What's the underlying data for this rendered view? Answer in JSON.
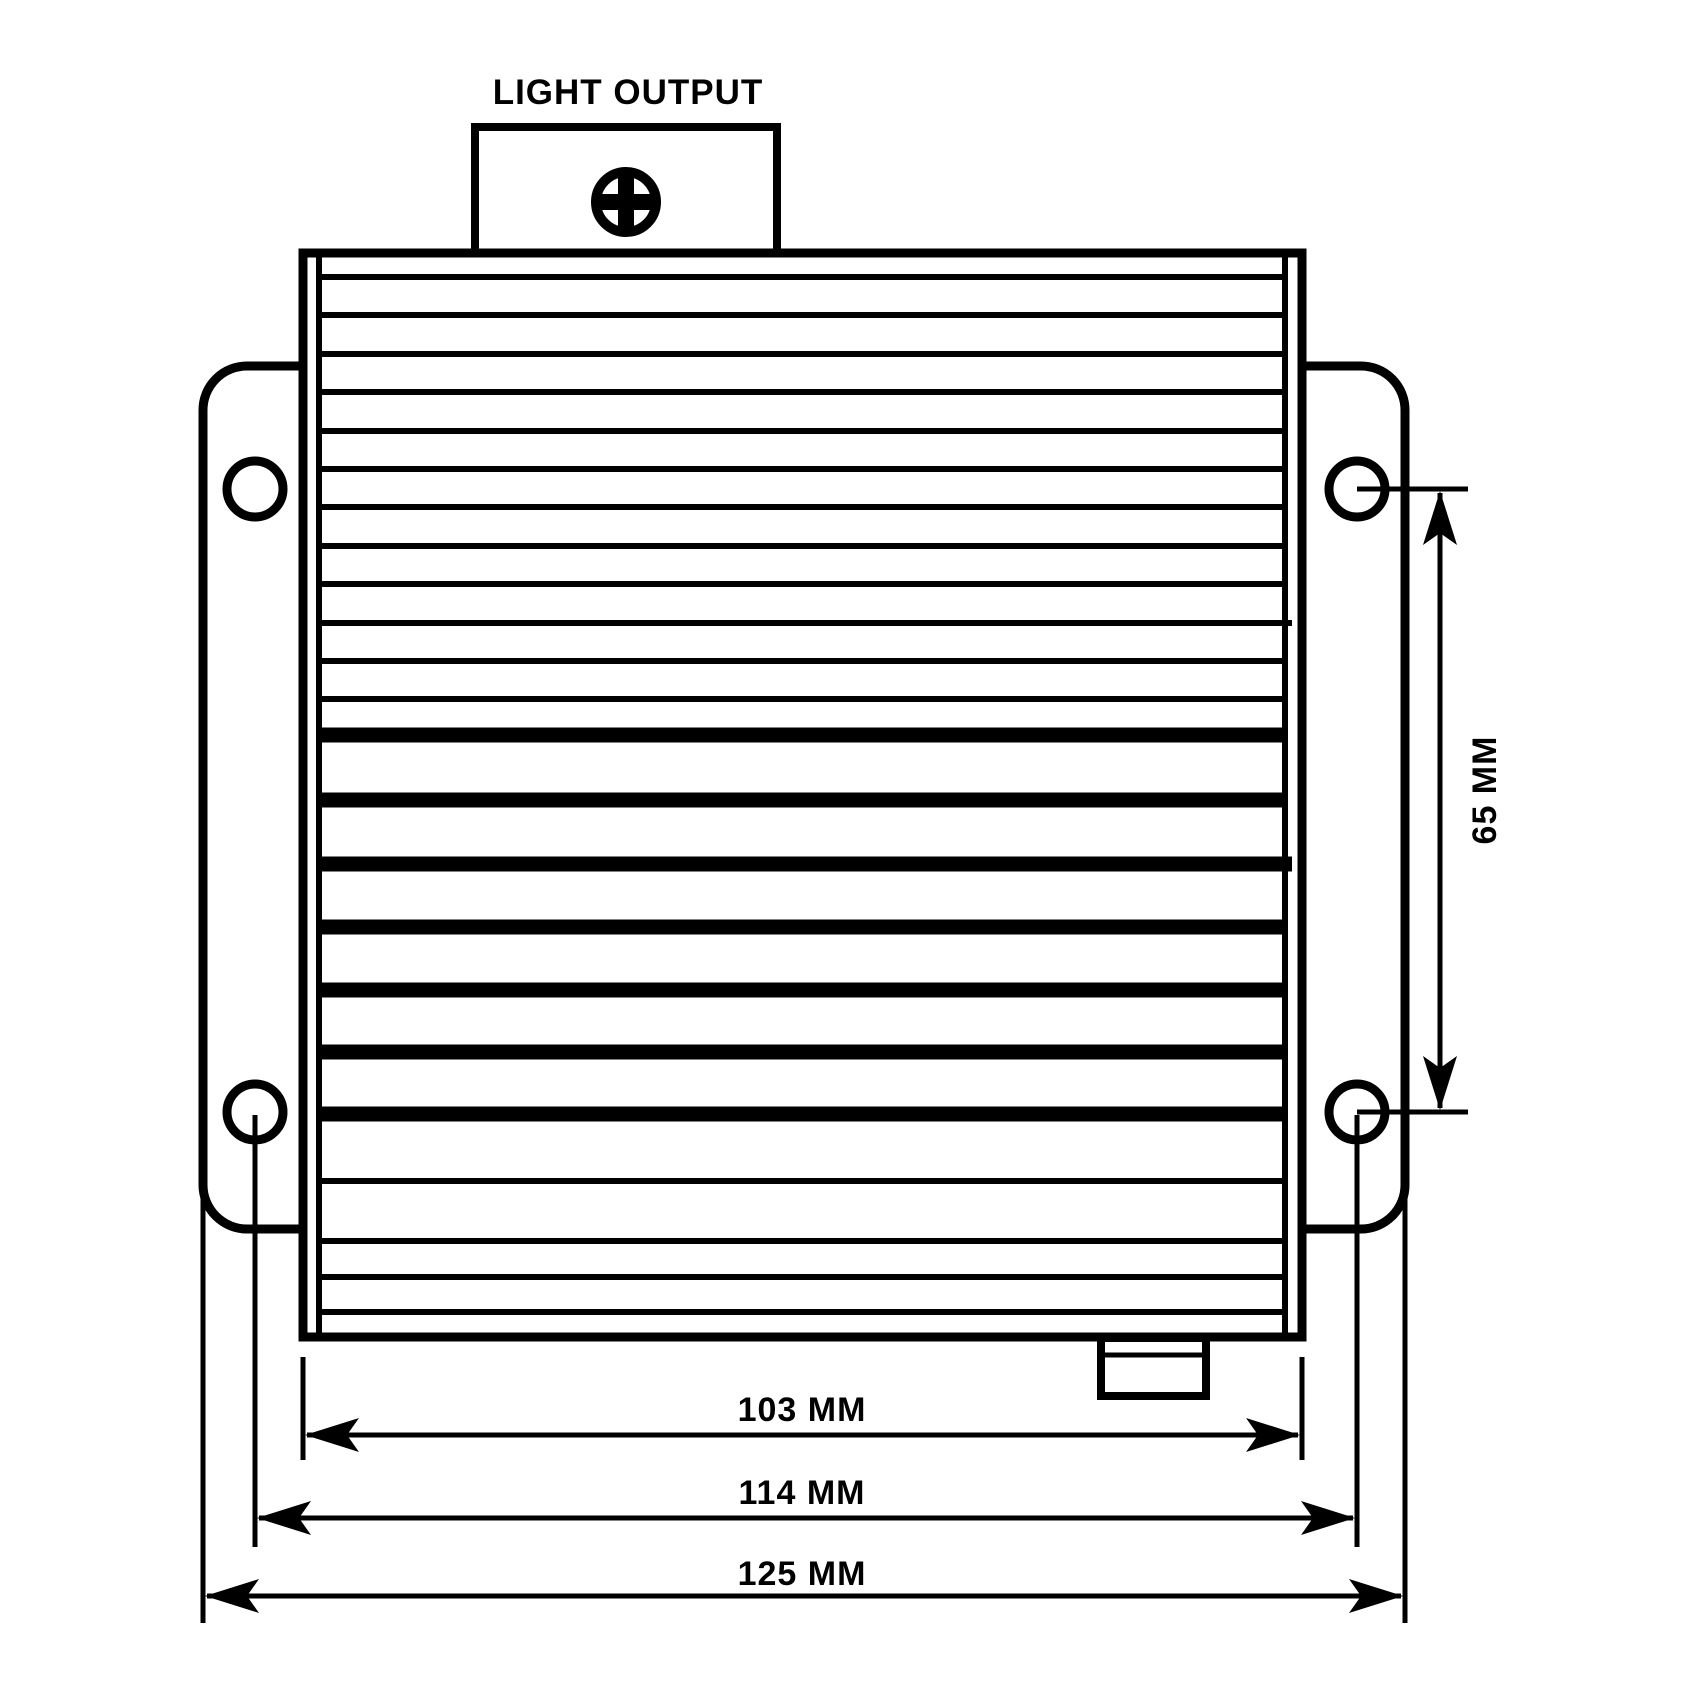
{
  "colors": {
    "ink": "#000000",
    "background": "#ffffff"
  },
  "annotations": {
    "light_output": "LIGHT OUTPUT"
  },
  "icons": {
    "screw": "phillips-screw-head"
  },
  "dimensions": [
    {
      "id": "inner-body-width",
      "label": "103 MM",
      "value": 103,
      "unit": "MM",
      "orientation": "horizontal"
    },
    {
      "id": "mounting-hole-span-width",
      "label": "114 MM",
      "value": 114,
      "unit": "MM",
      "orientation": "horizontal"
    },
    {
      "id": "overall-width",
      "label": "125 MM",
      "value": 125,
      "unit": "MM",
      "orientation": "horizontal"
    },
    {
      "id": "mounting-hole-span-height",
      "label": "65 MM",
      "value": 65,
      "unit": "MM",
      "orientation": "vertical"
    }
  ]
}
